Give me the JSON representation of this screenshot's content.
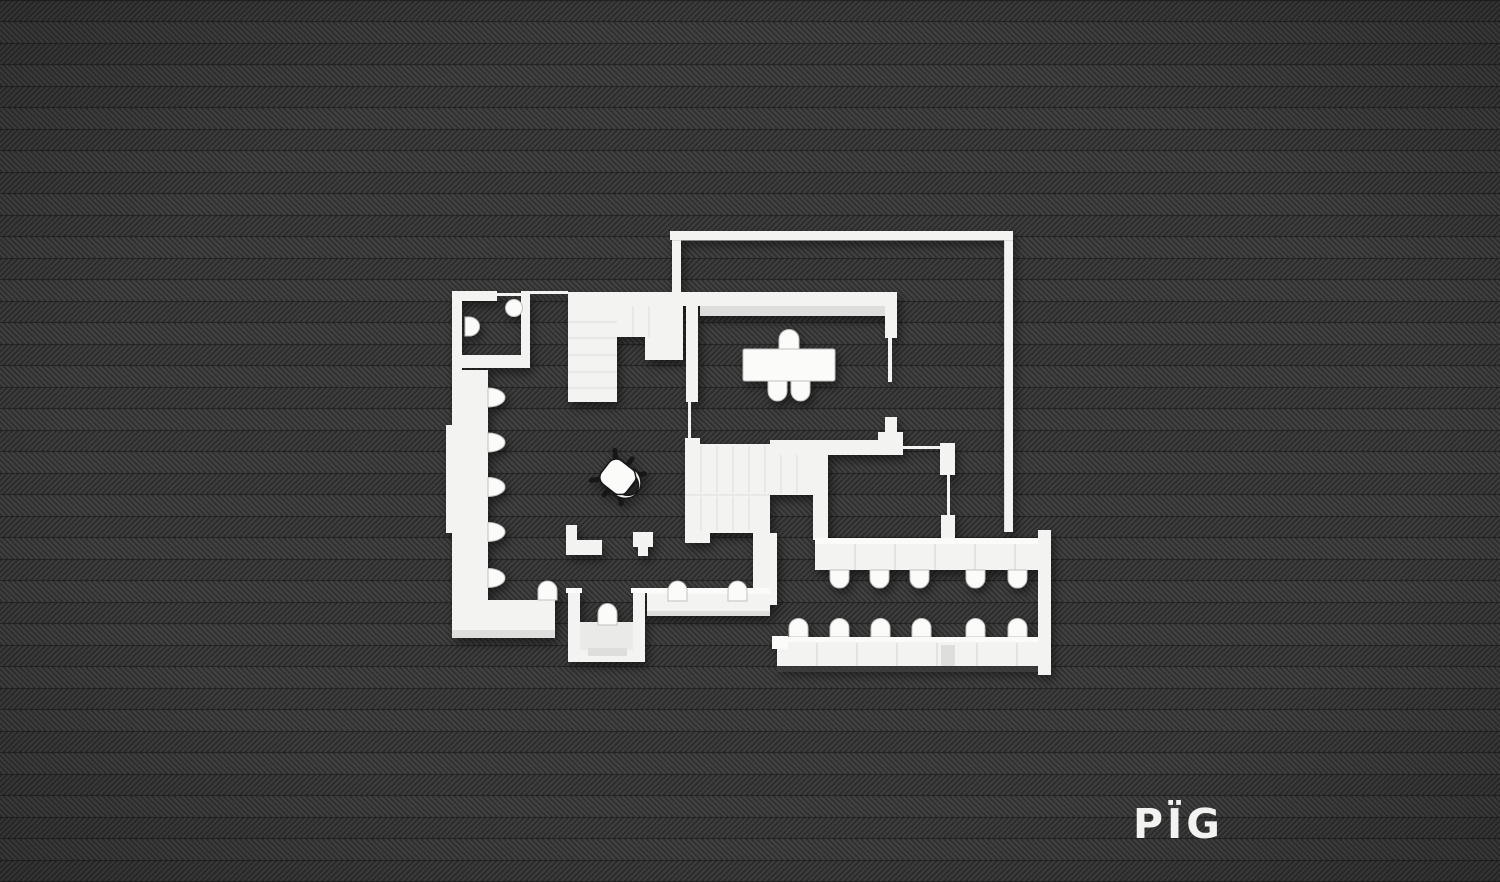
{
  "logo": {
    "text": "PÏG"
  },
  "colors": {
    "bg": "#2c2c2c",
    "stripe": "#3f3f3f",
    "seam": "#1e1e1e",
    "wall": "#f3f3f1",
    "wall_bright": "#fbfbf9",
    "wall_shade": "#dededc",
    "floor": "#eaeae8",
    "edge": "#c2c2c0",
    "ink": "#171717",
    "logo": "#f2f2f0"
  },
  "scene": {
    "description": "Top-down white architectural floor plan render on dark herringbone fabric background",
    "background_texture": "herringbone",
    "rooms": [
      {
        "name": "wc",
        "fixtures": [
          "toilet",
          "washbasin"
        ]
      },
      {
        "name": "upper-staircase",
        "fixtures": []
      },
      {
        "name": "dining-room",
        "fixtures": [
          "dining-table",
          "chair x3"
        ]
      },
      {
        "name": "hall",
        "fixtures": [
          "office-chair",
          "wall-column x5",
          "bench-seat x2",
          "pier x2"
        ]
      },
      {
        "name": "lower-staircase",
        "fixtures": []
      },
      {
        "name": "terrace",
        "fixtures": [
          "railing"
        ]
      },
      {
        "name": "side-room",
        "fixtures": []
      },
      {
        "name": "auditorium",
        "fixtures": [
          "counter x2",
          "seat-row-1 x5",
          "seat-row-2 x6"
        ]
      },
      {
        "name": "entrance-porch",
        "fixtures": [
          "seat x1",
          "step"
        ]
      }
    ],
    "counts": {
      "left-wall-columns": 5,
      "auditorium-seats-upper": 5,
      "auditorium-seats-lower": 6,
      "dining-chairs": 3
    }
  }
}
